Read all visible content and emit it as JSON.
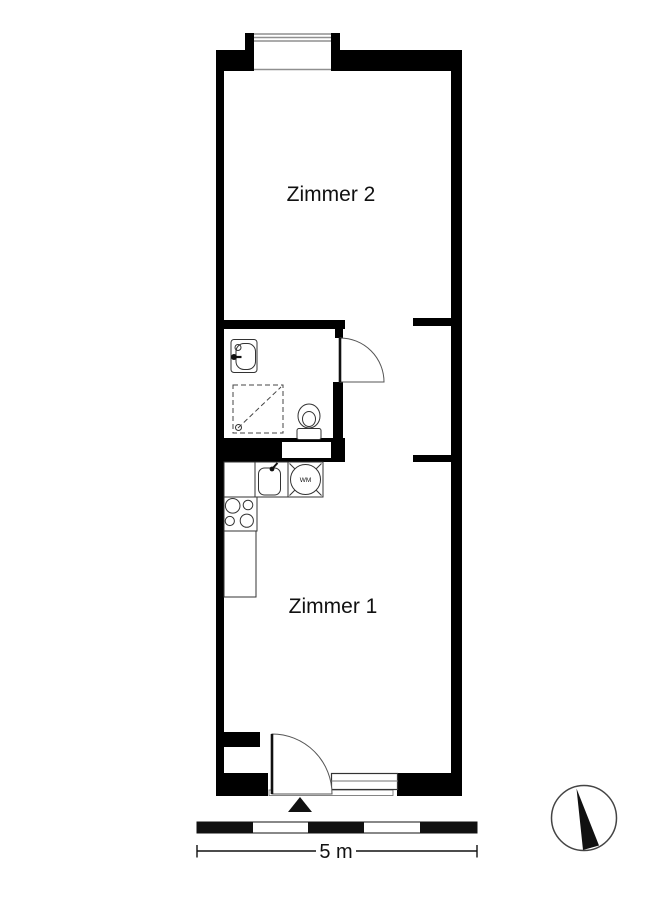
{
  "rooms": {
    "zimmer2_label": "Zimmer 2",
    "zimmer1_label": "Zimmer 1"
  },
  "kitchen": {
    "washing_machine_label": "WM"
  },
  "scale_bar": {
    "label": "5 m"
  },
  "icons": {
    "compass": "north-arrow-icon",
    "entrance_marker": "entrance-triangle-icon"
  },
  "colors": {
    "walls": "#000000",
    "background": "#ffffff",
    "outline": "#333333",
    "window_gray": "#8f8f8f"
  }
}
